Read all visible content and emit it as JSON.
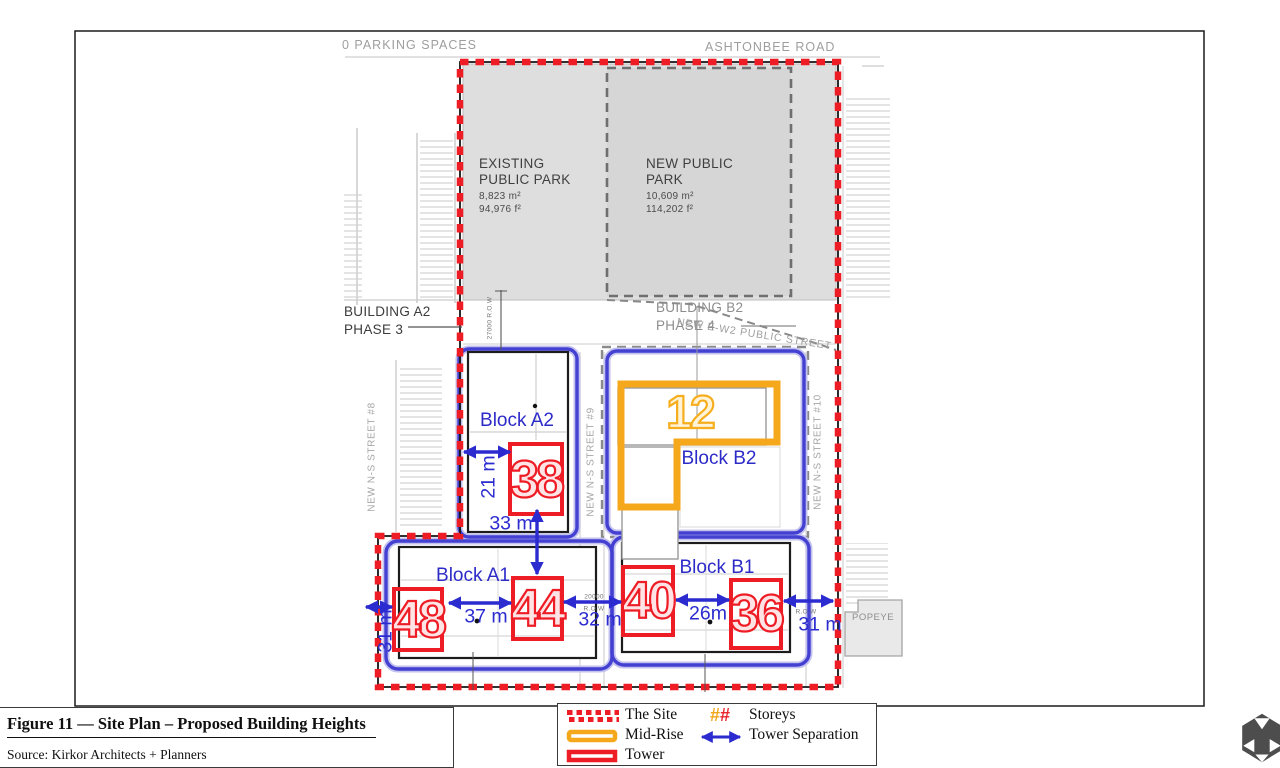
{
  "plan": {
    "parking_label": "0 PARKING SPACES",
    "road_top": "ASHTONBEE ROAD",
    "street_ns8": "NEW N-S STREET #8",
    "street_ns9": "NEW N-S STREET #9",
    "street_ns10": "NEW N-S STREET #10",
    "street_ew2": "NEW E-W2 PUBLIC STREET",
    "popeyes": "POPEYE",
    "existing_park": {
      "l1": "EXISTING",
      "l2": "PUBLIC PARK",
      "m2": "8,823 m²",
      "f2": "94,976 f²"
    },
    "new_park": {
      "l1": "NEW PUBLIC",
      "l2": "PARK",
      "m2": "10,609 m²",
      "f2": "114,202 f²"
    },
    "building_a2": {
      "l1": "BUILDING A2",
      "l2": "PHASE 3"
    },
    "building_b2": {
      "l1": "BUILDING B2",
      "l2": "PHASE 4"
    },
    "blocks": {
      "a2": "Block A2",
      "b2": "Block B2",
      "a1": "Block A1",
      "b1": "Block B1"
    },
    "storeys": {
      "t38": "38",
      "t48": "48",
      "t44": "44",
      "t40": "40",
      "t36": "36",
      "m12": "12"
    },
    "separations": {
      "s21": "21 m",
      "s33": "33 m",
      "s37": "37 m",
      "s32": "32 m",
      "s26": "26m",
      "s31e": "31 m",
      "s31w": "31 m"
    },
    "row_labels": {
      "r27000": "27000  R.O.W",
      "r20000": "20000",
      "row_mid": "R.O.W",
      "row_east": "R.O.W"
    }
  },
  "legend": {
    "site": "The Site",
    "midrise": "Mid-Rise",
    "tower": "Tower",
    "storeys": "Storeys",
    "separation": "Tower Separation",
    "hash1": "#",
    "hash2": "#"
  },
  "footer": {
    "title": "Figure 11 — Site Plan – Proposed Building Heights",
    "source": "Source: Kirkor Architects + Planners"
  },
  "colors": {
    "site_red": "#ee1c25",
    "midrise_orange": "#f5a81c",
    "separation_blue": "#2b2bd0",
    "block_blue": "#4340d2",
    "park_gray": "#dedede"
  }
}
